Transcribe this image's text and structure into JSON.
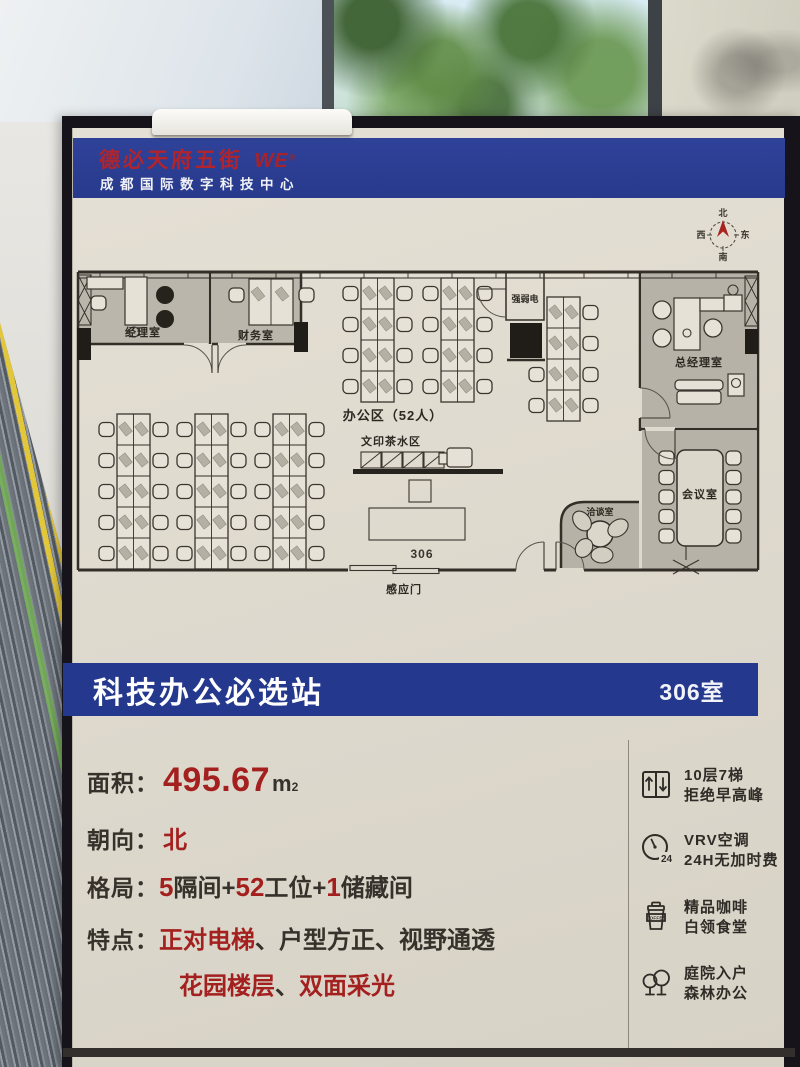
{
  "poster": {
    "header": {
      "brand": "德必天府五街",
      "logo": "WE",
      "logo_reg": "®",
      "subtitle": "成都国际数字科技中心"
    },
    "compass": {
      "north": "北",
      "south": "南",
      "east": "东",
      "west": "西"
    },
    "floorplan": {
      "manager_office": "经理室",
      "finance_office": "财务室",
      "open_office": "办公区（52人）",
      "utility_room": "强弱电",
      "gm_office": "总经理室",
      "print_tea_area": "文印茶水区",
      "negotiation_room": "洽谈室",
      "meeting_room": "会议室",
      "room_number": "306",
      "sensor_door": "感应门"
    },
    "title_banner": {
      "title": "科技办公必选站",
      "room_badge": "306室"
    },
    "specs": {
      "area_label": "面积：",
      "area_value": "495.67",
      "area_unit": "m",
      "area_unit_sup": "2",
      "orientation_label": "朝向：",
      "orientation_value": "北",
      "layout_label": "格局：",
      "layout_n1": "5",
      "layout_t1": "隔间+",
      "layout_n2": "52",
      "layout_t2": "工位+",
      "layout_n3": "1",
      "layout_t3": "储藏间",
      "features_label": "特点：",
      "features_red1": "正对电梯",
      "features_rest1": "、户型方正、视野通透",
      "features_red2a": "花园楼层",
      "features_sep2": "、",
      "features_red2b": "双面采光"
    },
    "amenities": [
      {
        "icon": "elevator-icon",
        "line1": "10层7梯",
        "line2": "拒绝早高峰"
      },
      {
        "icon": "clock-24-icon",
        "badge": "24",
        "line1": "VRV空调",
        "line2": "24H无加时费"
      },
      {
        "icon": "coffee-cup-icon",
        "badge": "COFFEE",
        "line1": "精品咖啡",
        "line2": "白领食堂"
      },
      {
        "icon": "trees-icon",
        "line1": "庭院入户",
        "line2": "森林办公"
      }
    ],
    "colors": {
      "banner_blue": "#283c90",
      "brand_red": "#a81f26",
      "accent_red": "#a3201f",
      "poster_beige": "#ded9cd"
    }
  }
}
